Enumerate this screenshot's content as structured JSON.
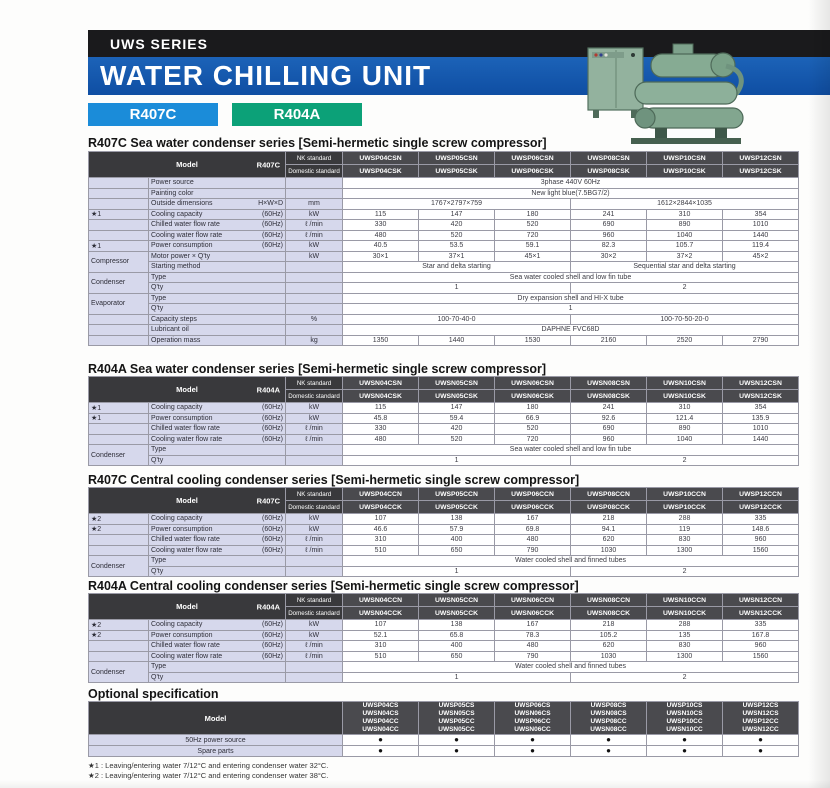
{
  "masthead": {
    "series_label": "UWS SERIES",
    "title": "WATER CHILLING UNIT",
    "refrigerant_tags": [
      {
        "label": "R407C",
        "color": "#1b8cd9"
      },
      {
        "label": "R404A",
        "color": "#0ca178"
      }
    ],
    "bar_black_color": "#1a1a1c",
    "bar_blue_color": "#1356ac"
  },
  "machine_image": {
    "name": "water-chilling-unit-photo"
  },
  "spec_tables": [
    {
      "title_main": "R407C Sea water condenser series",
      "title_bracket": "[Semi-hermetic single screw compressor]",
      "refrigerant": "R407C",
      "header": {
        "model_label": "Model",
        "nk_label": "NK standard",
        "domestic_label": "Domestic standard"
      },
      "nk_models": [
        "UWSP04CSN",
        "UWSP05CSN",
        "UWSP06CSN",
        "UWSP08CSN",
        "UWSP10CSN",
        "UWSP12CSN"
      ],
      "domestic_models": [
        "UWSP04CSK",
        "UWSP05CSK",
        "UWSP06CSK",
        "UWSP08CSK",
        "UWSP10CSK",
        "UWSP12CSK"
      ],
      "rows": [
        {
          "label": "Power source",
          "cells": [
            {
              "t": "3phase 440V  60Hz",
              "s": 6
            }
          ]
        },
        {
          "label": "Painting color",
          "cells": [
            {
              "t": "New light blue(7.5BG7/2)",
              "s": 6
            }
          ]
        },
        {
          "label": "Outside dimensions",
          "sub": "H×W×D",
          "unit": "mm",
          "cells": [
            {
              "t": "1767×2797×759",
              "s": 3
            },
            {
              "t": "1612×2844×1035",
              "s": 3
            }
          ]
        },
        {
          "star": "★1",
          "label": "Cooling capacity",
          "sub": "(60Hz)",
          "unit": "kW",
          "cells": [
            {
              "t": "115"
            },
            {
              "t": "147"
            },
            {
              "t": "180"
            },
            {
              "t": "241"
            },
            {
              "t": "310"
            },
            {
              "t": "354"
            }
          ]
        },
        {
          "label": "Chilled water flow rate",
          "sub": "(60Hz)",
          "unit": "ℓ /min",
          "cells": [
            {
              "t": "330"
            },
            {
              "t": "420"
            },
            {
              "t": "520"
            },
            {
              "t": "690"
            },
            {
              "t": "890"
            },
            {
              "t": "1010"
            }
          ]
        },
        {
          "label": "Cooling water flow rate",
          "sub": "(60Hz)",
          "unit": "ℓ /min",
          "cells": [
            {
              "t": "480"
            },
            {
              "t": "520"
            },
            {
              "t": "720"
            },
            {
              "t": "960"
            },
            {
              "t": "1040"
            },
            {
              "t": "1440"
            }
          ]
        },
        {
          "star": "★1",
          "label": "Power consumption",
          "sub": "(60Hz)",
          "unit": "kW",
          "cells": [
            {
              "t": "40.5"
            },
            {
              "t": "53.5"
            },
            {
              "t": "59.1"
            },
            {
              "t": "82.3"
            },
            {
              "t": "105.7"
            },
            {
              "t": "119.4"
            }
          ]
        },
        {
          "group": "Compressor",
          "gspan": 2,
          "label": "Motor power × Q'ty",
          "unit": "kW",
          "cells": [
            {
              "t": "30×1"
            },
            {
              "t": "37×1"
            },
            {
              "t": "45×1"
            },
            {
              "t": "30×2"
            },
            {
              "t": "37×2"
            },
            {
              "t": "45×2"
            }
          ]
        },
        {
          "ingroup": true,
          "label": "Starting method",
          "cells": [
            {
              "t": "Star and delta starting",
              "s": 3
            },
            {
              "t": "Sequential star and delta starting",
              "s": 3
            }
          ]
        },
        {
          "group": "Condenser",
          "gspan": 2,
          "label": "Type",
          "cells": [
            {
              "t": "Sea water cooled shell and low fin tube",
              "s": 6
            }
          ]
        },
        {
          "ingroup": true,
          "label": "Q'ty",
          "cells": [
            {
              "t": "1",
              "s": 3
            },
            {
              "t": "2",
              "s": 3
            }
          ]
        },
        {
          "group": "Evaporator",
          "gspan": 2,
          "label": "Type",
          "cells": [
            {
              "t": "Dry expansion shell and HI-X tube",
              "s": 6
            }
          ]
        },
        {
          "ingroup": true,
          "label": "Q'ty",
          "cells": [
            {
              "t": "1",
              "s": 6
            }
          ]
        },
        {
          "label": "Capacity steps",
          "unit": "%",
          "cells": [
            {
              "t": "100-70-40-0",
              "s": 3
            },
            {
              "t": "100-70-50-20-0",
              "s": 3
            }
          ]
        },
        {
          "label": "Lubricant oil",
          "cells": [
            {
              "t": "DAPHNE FVC68D",
              "s": 6
            }
          ]
        },
        {
          "label": "Operation mass",
          "unit": "kg",
          "cells": [
            {
              "t": "1350"
            },
            {
              "t": "1440"
            },
            {
              "t": "1530"
            },
            {
              "t": "2160"
            },
            {
              "t": "2520"
            },
            {
              "t": "2790"
            }
          ]
        }
      ]
    },
    {
      "title_main": "R404A Sea water condenser series",
      "title_bracket": "[Semi-hermetic single screw compressor]",
      "refrigerant": "R404A",
      "header": {
        "model_label": "Model",
        "nk_label": "NK standard",
        "domestic_label": "Domestic standard"
      },
      "nk_models": [
        "UWSN04CSN",
        "UWSN05CSN",
        "UWSN06CSN",
        "UWSN08CSN",
        "UWSN10CSN",
        "UWSN12CSN"
      ],
      "domestic_models": [
        "UWSN04CSK",
        "UWSN05CSK",
        "UWSN06CSK",
        "UWSN08CSK",
        "UWSN10CSK",
        "UWSN12CSK"
      ],
      "rows": [
        {
          "star": "★1",
          "label": "Cooling capacity",
          "sub": "(60Hz)",
          "unit": "kW",
          "cells": [
            {
              "t": "115"
            },
            {
              "t": "147"
            },
            {
              "t": "180"
            },
            {
              "t": "241"
            },
            {
              "t": "310"
            },
            {
              "t": "354"
            }
          ]
        },
        {
          "star": "★1",
          "label": "Power consumption",
          "sub": "(60Hz)",
          "unit": "kW",
          "cells": [
            {
              "t": "45.8"
            },
            {
              "t": "59.4"
            },
            {
              "t": "66.9"
            },
            {
              "t": "92.6"
            },
            {
              "t": "121.4"
            },
            {
              "t": "135.9"
            }
          ]
        },
        {
          "label": "Chilled water flow rate",
          "sub": "(60Hz)",
          "unit": "ℓ /min",
          "cells": [
            {
              "t": "330"
            },
            {
              "t": "420"
            },
            {
              "t": "520"
            },
            {
              "t": "690"
            },
            {
              "t": "890"
            },
            {
              "t": "1010"
            }
          ]
        },
        {
          "label": "Cooling water flow rate",
          "sub": "(60Hz)",
          "unit": "ℓ /min",
          "cells": [
            {
              "t": "480"
            },
            {
              "t": "520"
            },
            {
              "t": "720"
            },
            {
              "t": "960"
            },
            {
              "t": "1040"
            },
            {
              "t": "1440"
            }
          ]
        },
        {
          "group": "Condenser",
          "gspan": 2,
          "label": "Type",
          "cells": [
            {
              "t": "Sea water cooled shell and low fin tube",
              "s": 6
            }
          ]
        },
        {
          "ingroup": true,
          "label": "Q'ty",
          "cells": [
            {
              "t": "1",
              "s": 3
            },
            {
              "t": "2",
              "s": 3
            }
          ]
        }
      ]
    },
    {
      "title_main": "R407C Central cooling condenser series",
      "title_bracket": "[Semi-hermetic single screw compressor]",
      "refrigerant": "R407C",
      "header": {
        "model_label": "Model",
        "nk_label": "NK standard",
        "domestic_label": "Domestic standard"
      },
      "nk_models": [
        "UWSP04CCN",
        "UWSP05CCN",
        "UWSP06CCN",
        "UWSP08CCN",
        "UWSP10CCN",
        "UWSP12CCN"
      ],
      "domestic_models": [
        "UWSP04CCK",
        "UWSP05CCK",
        "UWSP06CCK",
        "UWSP08CCK",
        "UWSP10CCK",
        "UWSP12CCK"
      ],
      "rows": [
        {
          "star": "★2",
          "label": "Cooling capacity",
          "sub": "(60Hz)",
          "unit": "kW",
          "cells": [
            {
              "t": "107"
            },
            {
              "t": "138"
            },
            {
              "t": "167"
            },
            {
              "t": "218"
            },
            {
              "t": "288"
            },
            {
              "t": "335"
            }
          ]
        },
        {
          "star": "★2",
          "label": "Power consumption",
          "sub": "(60Hz)",
          "unit": "kW",
          "cells": [
            {
              "t": "46.6"
            },
            {
              "t": "57.9"
            },
            {
              "t": "69.8"
            },
            {
              "t": "94.1"
            },
            {
              "t": "119"
            },
            {
              "t": "148.6"
            }
          ]
        },
        {
          "label": "Chilled water flow rate",
          "sub": "(60Hz)",
          "unit": "ℓ /min",
          "cells": [
            {
              "t": "310"
            },
            {
              "t": "400"
            },
            {
              "t": "480"
            },
            {
              "t": "620"
            },
            {
              "t": "830"
            },
            {
              "t": "960"
            }
          ]
        },
        {
          "label": "Cooling water flow rate",
          "sub": "(60Hz)",
          "unit": "ℓ /min",
          "cells": [
            {
              "t": "510"
            },
            {
              "t": "650"
            },
            {
              "t": "790"
            },
            {
              "t": "1030"
            },
            {
              "t": "1300"
            },
            {
              "t": "1560"
            }
          ]
        },
        {
          "group": "Condenser",
          "gspan": 2,
          "label": "Type",
          "cells": [
            {
              "t": "Water cooled shell and finned tubes",
              "s": 6
            }
          ]
        },
        {
          "ingroup": true,
          "label": "Q'ty",
          "cells": [
            {
              "t": "1",
              "s": 3
            },
            {
              "t": "2",
              "s": 3
            }
          ]
        }
      ]
    },
    {
      "title_main": "R404A Central cooling condenser series",
      "title_bracket": "[Semi-hermetic single screw compressor]",
      "refrigerant": "R404A",
      "header": {
        "model_label": "Model",
        "nk_label": "NK standard",
        "domestic_label": "Domestic standard"
      },
      "nk_models": [
        "UWSN04CCN",
        "UWSN05CCN",
        "UWSN06CCN",
        "UWSN08CCN",
        "UWSN10CCN",
        "UWSN12CCN"
      ],
      "domestic_models": [
        "UWSN04CCK",
        "UWSN05CCK",
        "UWSN06CCK",
        "UWSN08CCK",
        "UWSN10CCK",
        "UWSN12CCK"
      ],
      "rows": [
        {
          "star": "★2",
          "label": "Cooling capacity",
          "sub": "(60Hz)",
          "unit": "kW",
          "cells": [
            {
              "t": "107"
            },
            {
              "t": "138"
            },
            {
              "t": "167"
            },
            {
              "t": "218"
            },
            {
              "t": "288"
            },
            {
              "t": "335"
            }
          ]
        },
        {
          "star": "★2",
          "label": "Power consumption",
          "sub": "(60Hz)",
          "unit": "kW",
          "cells": [
            {
              "t": "52.1"
            },
            {
              "t": "65.8"
            },
            {
              "t": "78.3"
            },
            {
              "t": "105.2"
            },
            {
              "t": "135"
            },
            {
              "t": "167.8"
            }
          ]
        },
        {
          "label": "Chilled water flow rate",
          "sub": "(60Hz)",
          "unit": "ℓ /min",
          "cells": [
            {
              "t": "310"
            },
            {
              "t": "400"
            },
            {
              "t": "480"
            },
            {
              "t": "620"
            },
            {
              "t": "830"
            },
            {
              "t": "960"
            }
          ]
        },
        {
          "label": "Cooling water flow rate",
          "sub": "(60Hz)",
          "unit": "ℓ /min",
          "cells": [
            {
              "t": "510"
            },
            {
              "t": "650"
            },
            {
              "t": "790"
            },
            {
              "t": "1030"
            },
            {
              "t": "1300"
            },
            {
              "t": "1560"
            }
          ]
        },
        {
          "group": "Condenser",
          "gspan": 2,
          "label": "Type",
          "cells": [
            {
              "t": "Water cooled shell and finned tubes",
              "s": 6
            }
          ]
        },
        {
          "ingroup": true,
          "label": "Q'ty",
          "cells": [
            {
              "t": "1",
              "s": 3
            },
            {
              "t": "2",
              "s": 3
            }
          ]
        }
      ]
    }
  ],
  "optional": {
    "title": "Optional specification",
    "model_label": "Model",
    "model_columns": [
      [
        "UWSP04CS",
        "UWSN04CS",
        "UWSP04CC",
        "UWSN04CC"
      ],
      [
        "UWSP05CS",
        "UWSN05CS",
        "UWSP05CC",
        "UWSN05CC"
      ],
      [
        "UWSP06CS",
        "UWSN06CS",
        "UWSP06CC",
        "UWSN06CC"
      ],
      [
        "UWSP08CS",
        "UWSN08CS",
        "UWSP08CC",
        "UWSN08CC"
      ],
      [
        "UWSP10CS",
        "UWSN10CS",
        "UWSP10CC",
        "UWSN10CC"
      ],
      [
        "UWSP12CS",
        "UWSN12CS",
        "UWSP12CC",
        "UWSN12CC"
      ]
    ],
    "rows": [
      {
        "label": "50Hz power source",
        "dots": [
          true,
          true,
          true,
          true,
          true,
          true
        ]
      },
      {
        "label": "Spare parts",
        "dots": [
          true,
          true,
          true,
          true,
          true,
          true
        ]
      }
    ],
    "dot_glyph": "●"
  },
  "footnotes": [
    "★1 : Leaving/entering water 7/12°C and entering condenser water 32°C.",
    "★2 : Leaving/entering water 7/12°C and entering condenser water 38°C."
  ]
}
